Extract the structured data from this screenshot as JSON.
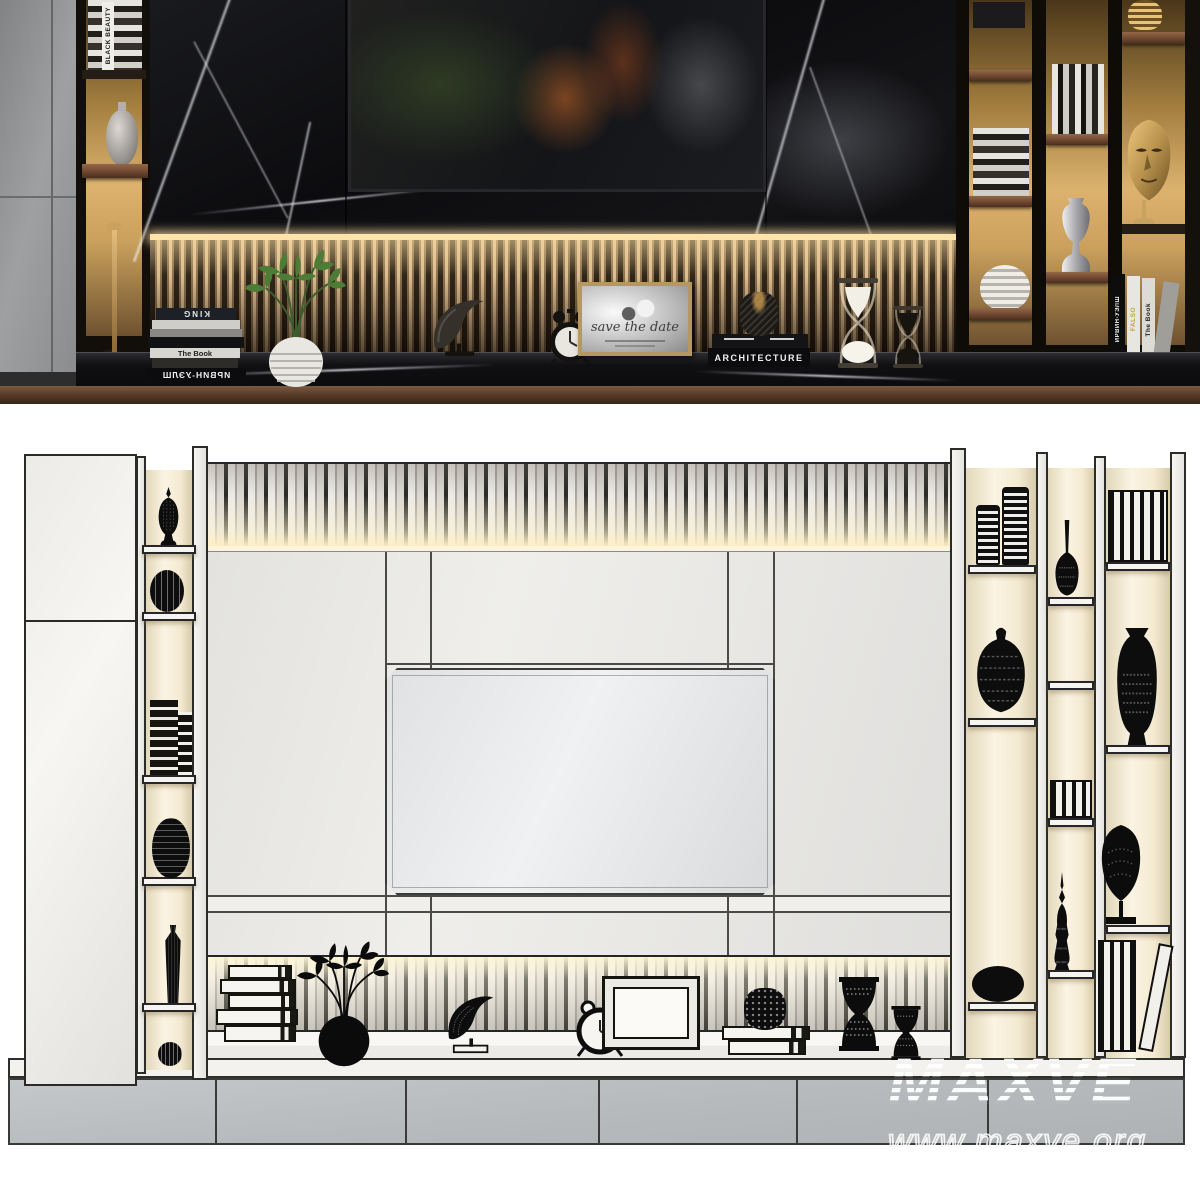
{
  "watermark": {
    "brand": "MAXVE",
    "url": "www.maxve.org"
  },
  "top_render": {
    "left_column_spine": "BLACK BEAUTY",
    "counter_stack": {
      "spine_king": "KING",
      "spine_the_book": "The Book",
      "spine_author": "ИРВИН-УЭЛШ"
    },
    "photo_frame_caption": "save the date",
    "books_architecture": "ARCHITECTURE",
    "right_shelf": {
      "spine_author": "ИРВИН-УЭЛШ",
      "spine_falso": "FALSO",
      "spine_the_book": "The Book"
    }
  },
  "colors": {
    "canvas_bg": "#ffffff",
    "marble_black": "#0e0e11",
    "backlight_gold": "#d9ae6a",
    "backlight_cream": "#f7efdc",
    "wood_shelf": "#6b452e",
    "cabinet_gray": "#8f9193",
    "clay_white": "#f2f1ed",
    "outline_dark": "#26262a",
    "base_gray": "#b9bdbf",
    "watermark_white": "#ffffff"
  }
}
